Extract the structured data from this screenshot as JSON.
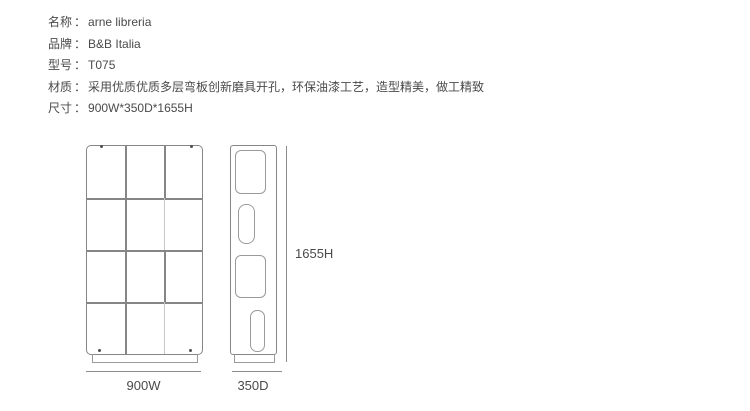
{
  "colors": {
    "background": "#ffffff",
    "text": "#4a4a4a",
    "drawing_line": "#868686",
    "drawing_line_light": "#c6c6c6",
    "dimension_line": "#8d8d8d"
  },
  "spec": {
    "colon": "：",
    "items": [
      {
        "label": "名称",
        "value": "arne libreria"
      },
      {
        "label": "品牌",
        "value": "B&B Italia"
      },
      {
        "label": "型号",
        "value": "T075"
      },
      {
        "label": "材质",
        "value": "采用优质优质多层弯板创新磨具开孔，环保油漆工艺，造型精美，做工精致"
      },
      {
        "label": "尺寸",
        "value": "900W*350D*1655H"
      }
    ]
  },
  "dimensions": {
    "front_width_label": "900W",
    "side_depth_label": "350D",
    "height_label": "1655H"
  }
}
